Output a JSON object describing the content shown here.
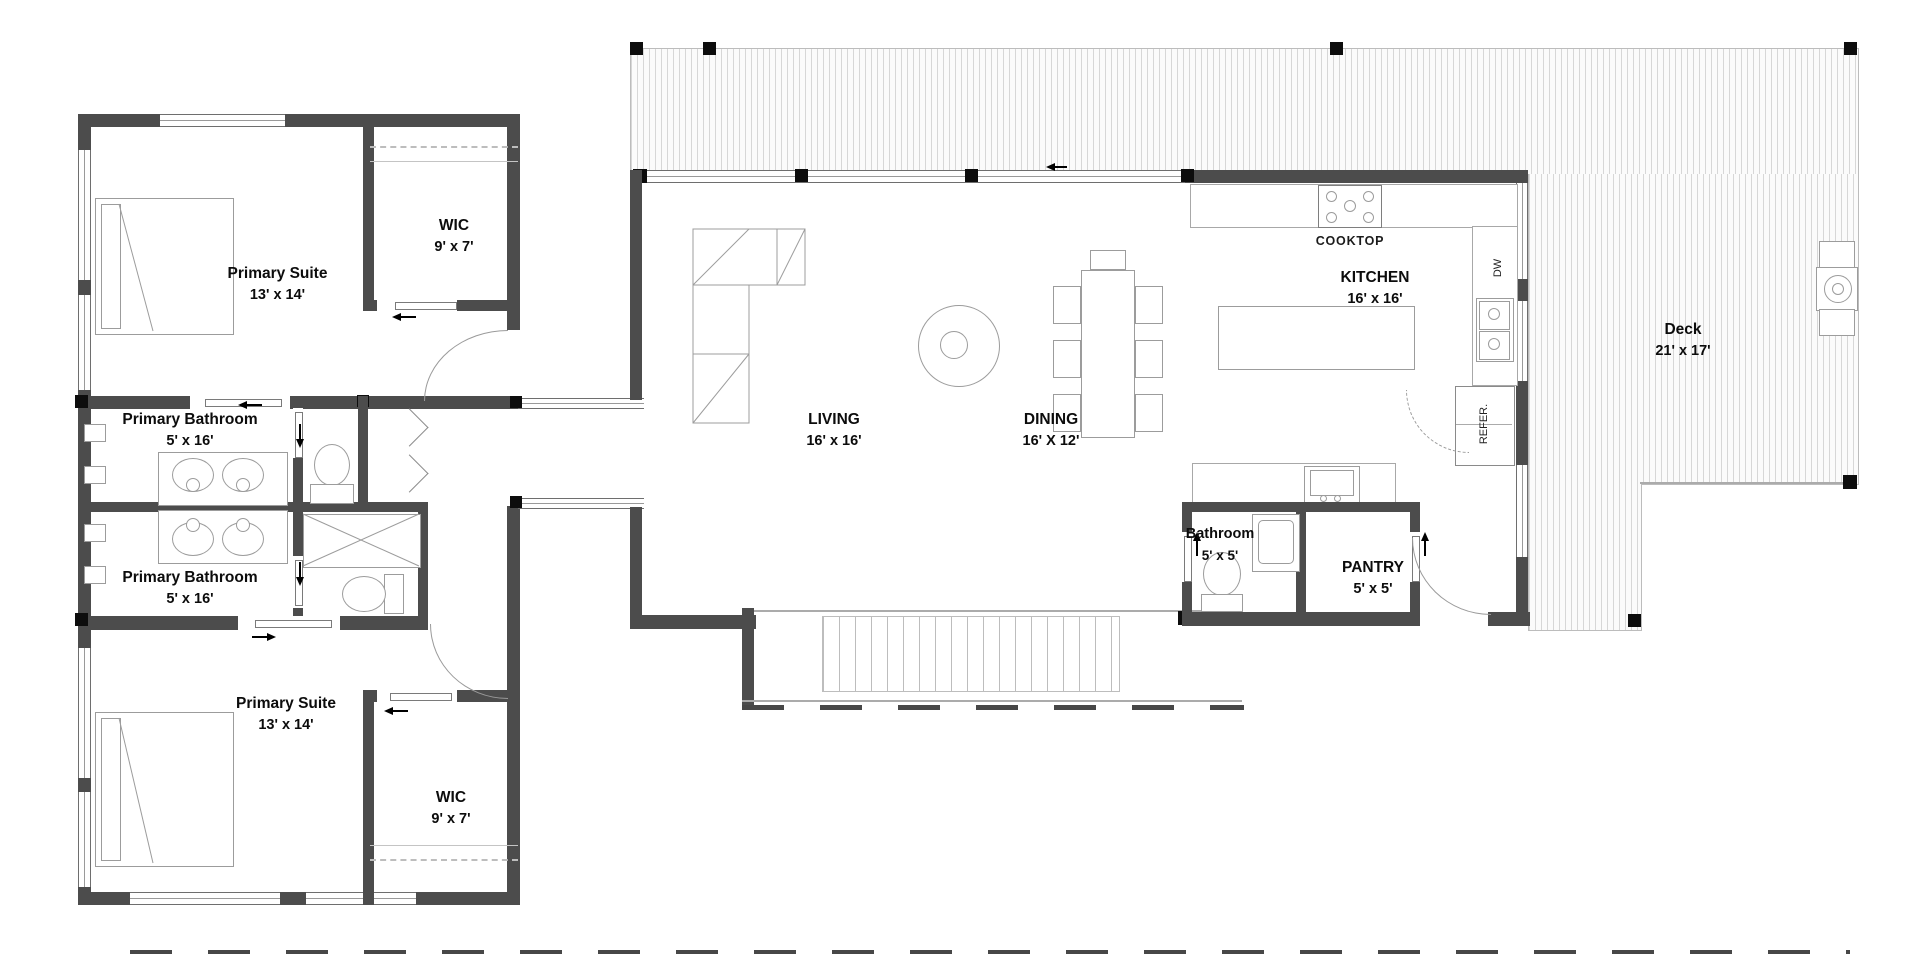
{
  "rooms": {
    "primary_suite_top": {
      "name": "Primary Suite",
      "dims": "13' x 14'"
    },
    "wic_top": {
      "name": "WIC",
      "dims": "9' x 7'"
    },
    "primary_bath_top": {
      "name": "Primary Bathroom",
      "dims": "5' x 16'"
    },
    "primary_bath_bottom": {
      "name": "Primary Bathroom",
      "dims": "5' x 16'"
    },
    "primary_suite_bottom": {
      "name": "Primary Suite",
      "dims": "13' x 14'"
    },
    "wic_bottom": {
      "name": "WIC",
      "dims": "9' x 7'"
    },
    "living": {
      "name": "LIVING",
      "dims": "16' x 16'"
    },
    "dining": {
      "name": "DINING",
      "dims": "16' X 12'"
    },
    "kitchen": {
      "name": "KITCHEN",
      "dims": "16' x 16'"
    },
    "bathroom": {
      "name": "Bathroom",
      "dims": "5' x 5'"
    },
    "pantry": {
      "name": "PANTRY",
      "dims": "5' x 5'"
    },
    "deck": {
      "name": "Deck",
      "dims": "21' x 17'"
    }
  },
  "labels": {
    "cooktop": "COOKTOP",
    "dishwasher": "DW",
    "refrigerator": "REFER."
  },
  "colors": {
    "wall": "#4c4c4c",
    "furniture_line": "#9c9c9c",
    "hatch_line": "#d7d7d7",
    "text": "#0c0c0c"
  }
}
